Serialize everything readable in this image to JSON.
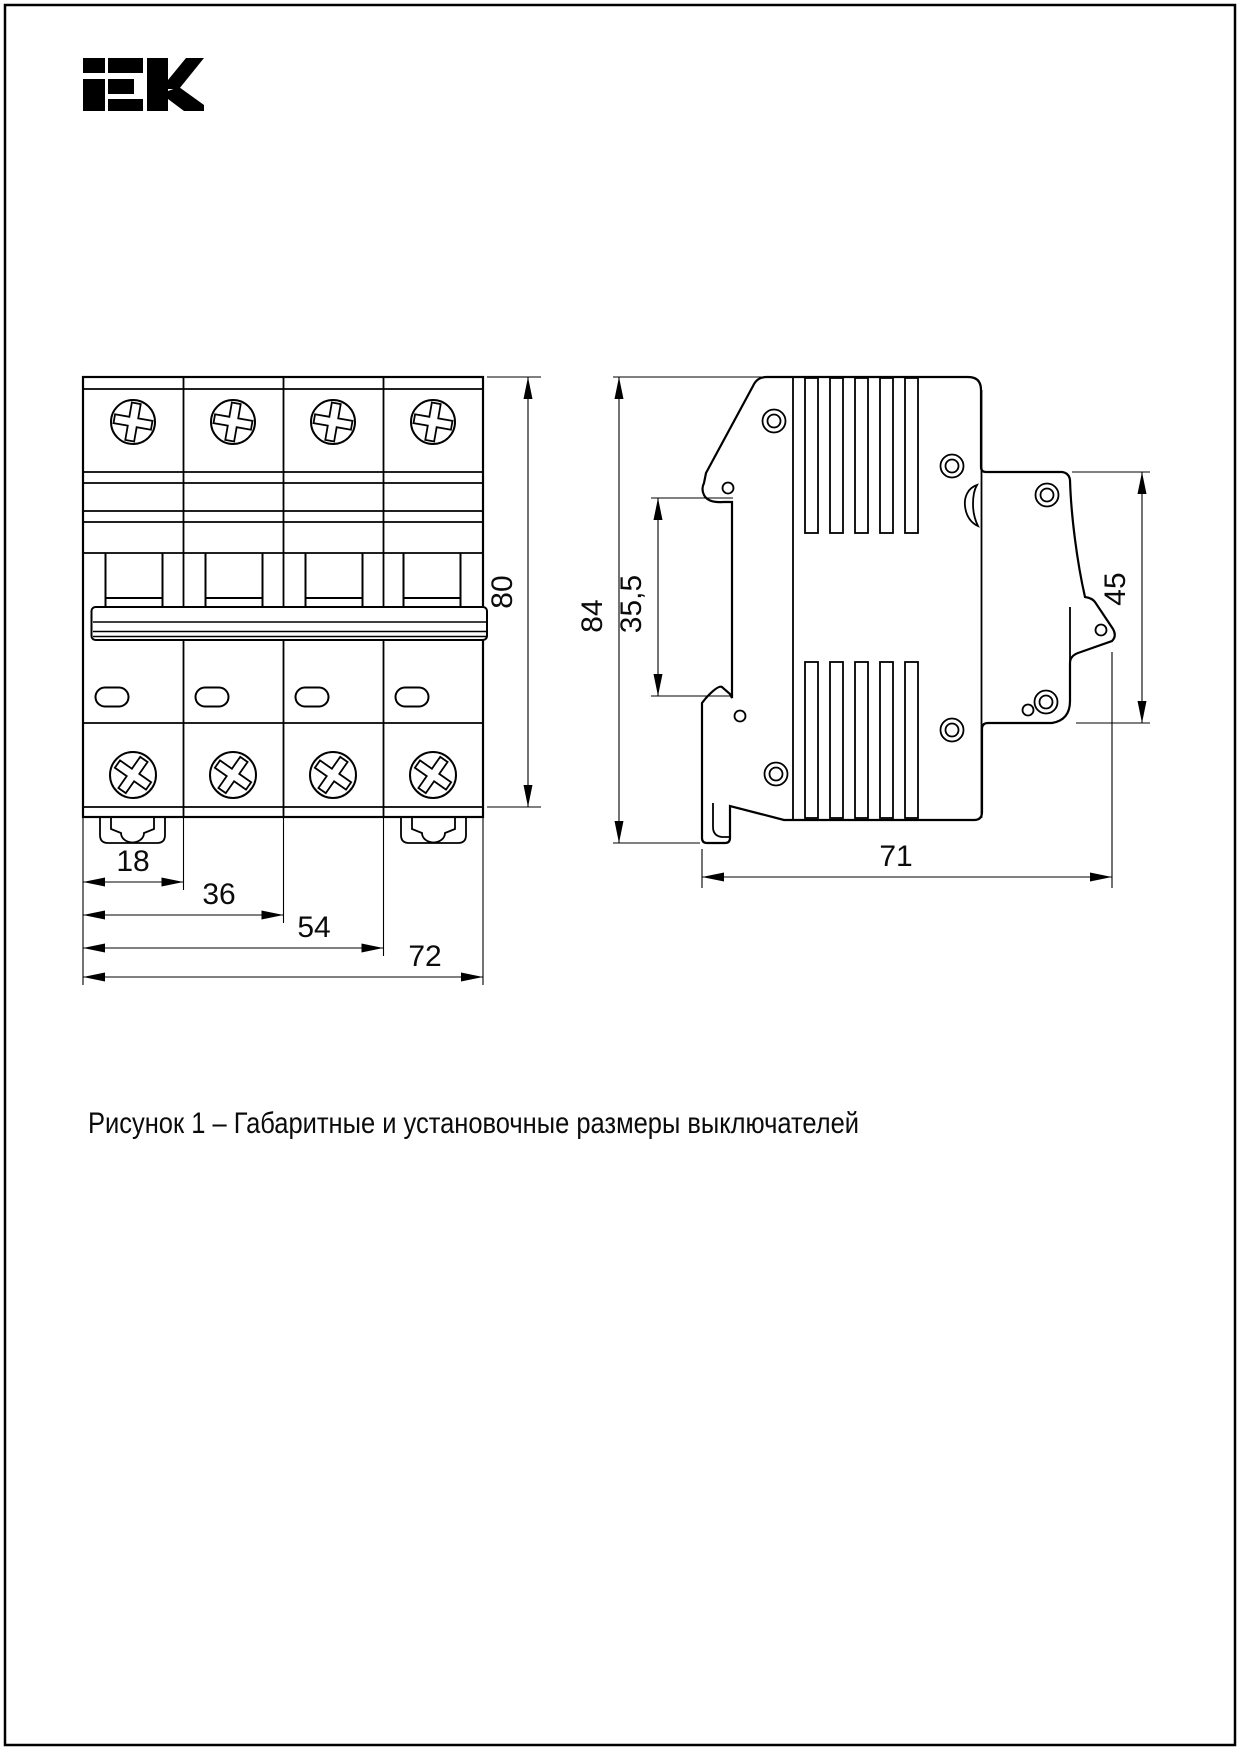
{
  "logo": {
    "brand": "iEK"
  },
  "caption": "Рисунок 1 – Габаритные и установочные размеры выключателей",
  "front_view": {
    "dims": {
      "height": "80",
      "module": "18",
      "two_modules": "36",
      "three_modules": "54",
      "width": "72"
    }
  },
  "side_view": {
    "dims": {
      "height": "84",
      "din_recess": "35,5",
      "front_face": "45",
      "depth": "71"
    }
  }
}
